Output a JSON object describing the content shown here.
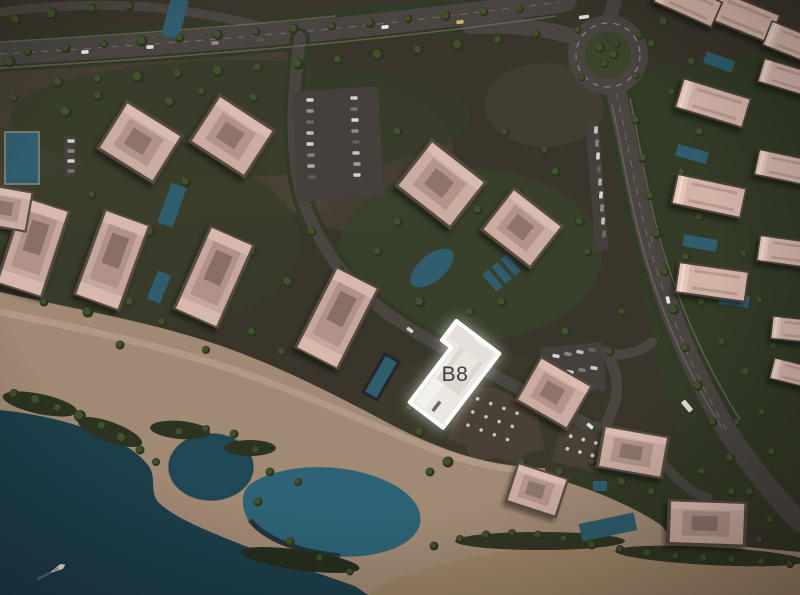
{
  "view": {
    "selected_building": {
      "label": "B8"
    },
    "palette": {
      "highlight_fill": "#ebe8e3",
      "highlight_outline": "#ffffff",
      "label_text": "#3e3e3e",
      "sea": "#1d3f4b",
      "lagoon": "#2d6374",
      "pool": "#2f5d6d",
      "sand": "#a18a74",
      "greenery": "#39402a",
      "road": "#4a4541",
      "rooftop": "#cbaca1"
    },
    "icons": [
      "boat-icon",
      "bus-icon",
      "car-icon"
    ]
  }
}
